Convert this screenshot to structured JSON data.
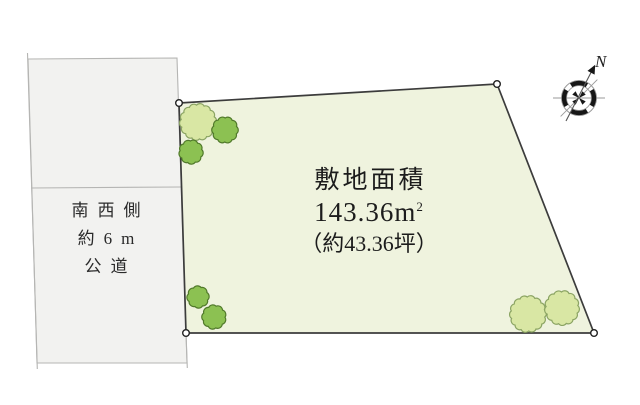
{
  "site": {
    "area_title": "敷地面積",
    "area_value": "143.36m",
    "area_sup": "2",
    "area_tsubo": "（約43.36坪）"
  },
  "road": {
    "lines": [
      "南西側",
      "約6m",
      "公道"
    ]
  },
  "compass": {
    "north_label": "N"
  },
  "colors": {
    "plot_fill": "#eff3de",
    "plot_stroke": "#3c3c3c",
    "road_fill": "#f2f2f0",
    "road_stroke": "#b5b5b3",
    "tree_light_fill": "#d9e7a4",
    "tree_light_stroke": "#8ba463",
    "tree_green_fill": "#8cc152",
    "tree_green_stroke": "#50792a",
    "marker_fill": "#ffffff",
    "marker_stroke": "#222222",
    "compass_dark": "#161616",
    "compass_gray": "#9a9a9a",
    "text_color": "#1c1c1c"
  },
  "site_plan": {
    "plot_points": [
      [
        179,
        103
      ],
      [
        497,
        84
      ],
      [
        594,
        333
      ],
      [
        186,
        333
      ]
    ],
    "road_points": [
      [
        28,
        59
      ],
      [
        177,
        58
      ],
      [
        187,
        363
      ],
      [
        37,
        363
      ]
    ],
    "road_divider": [
      [
        31,
        188
      ],
      [
        181,
        187
      ]
    ],
    "road_left_edge_ext": [
      [
        27.5,
        53
      ],
      [
        37.3,
        369
      ]
    ],
    "road_right_edge_ext": [
      [
        186,
        333
      ],
      [
        187.3,
        368
      ]
    ],
    "corner_markers": [
      [
        179,
        103
      ],
      [
        497,
        84
      ],
      [
        594,
        333
      ],
      [
        186,
        333
      ]
    ],
    "trees": [
      {
        "type": "light",
        "cx": 198,
        "cy": 122,
        "r": 17
      },
      {
        "type": "green",
        "cx": 225,
        "cy": 130,
        "r": 12
      },
      {
        "type": "green",
        "cx": 191,
        "cy": 152,
        "r": 11
      },
      {
        "type": "green",
        "cx": 198,
        "cy": 297,
        "r": 10
      },
      {
        "type": "green",
        "cx": 214,
        "cy": 317,
        "r": 11
      },
      {
        "type": "light",
        "cx": 528,
        "cy": 314,
        "r": 17
      },
      {
        "type": "light",
        "cx": 562,
        "cy": 308,
        "r": 16
      }
    ],
    "compass_center": [
      579,
      98
    ]
  }
}
